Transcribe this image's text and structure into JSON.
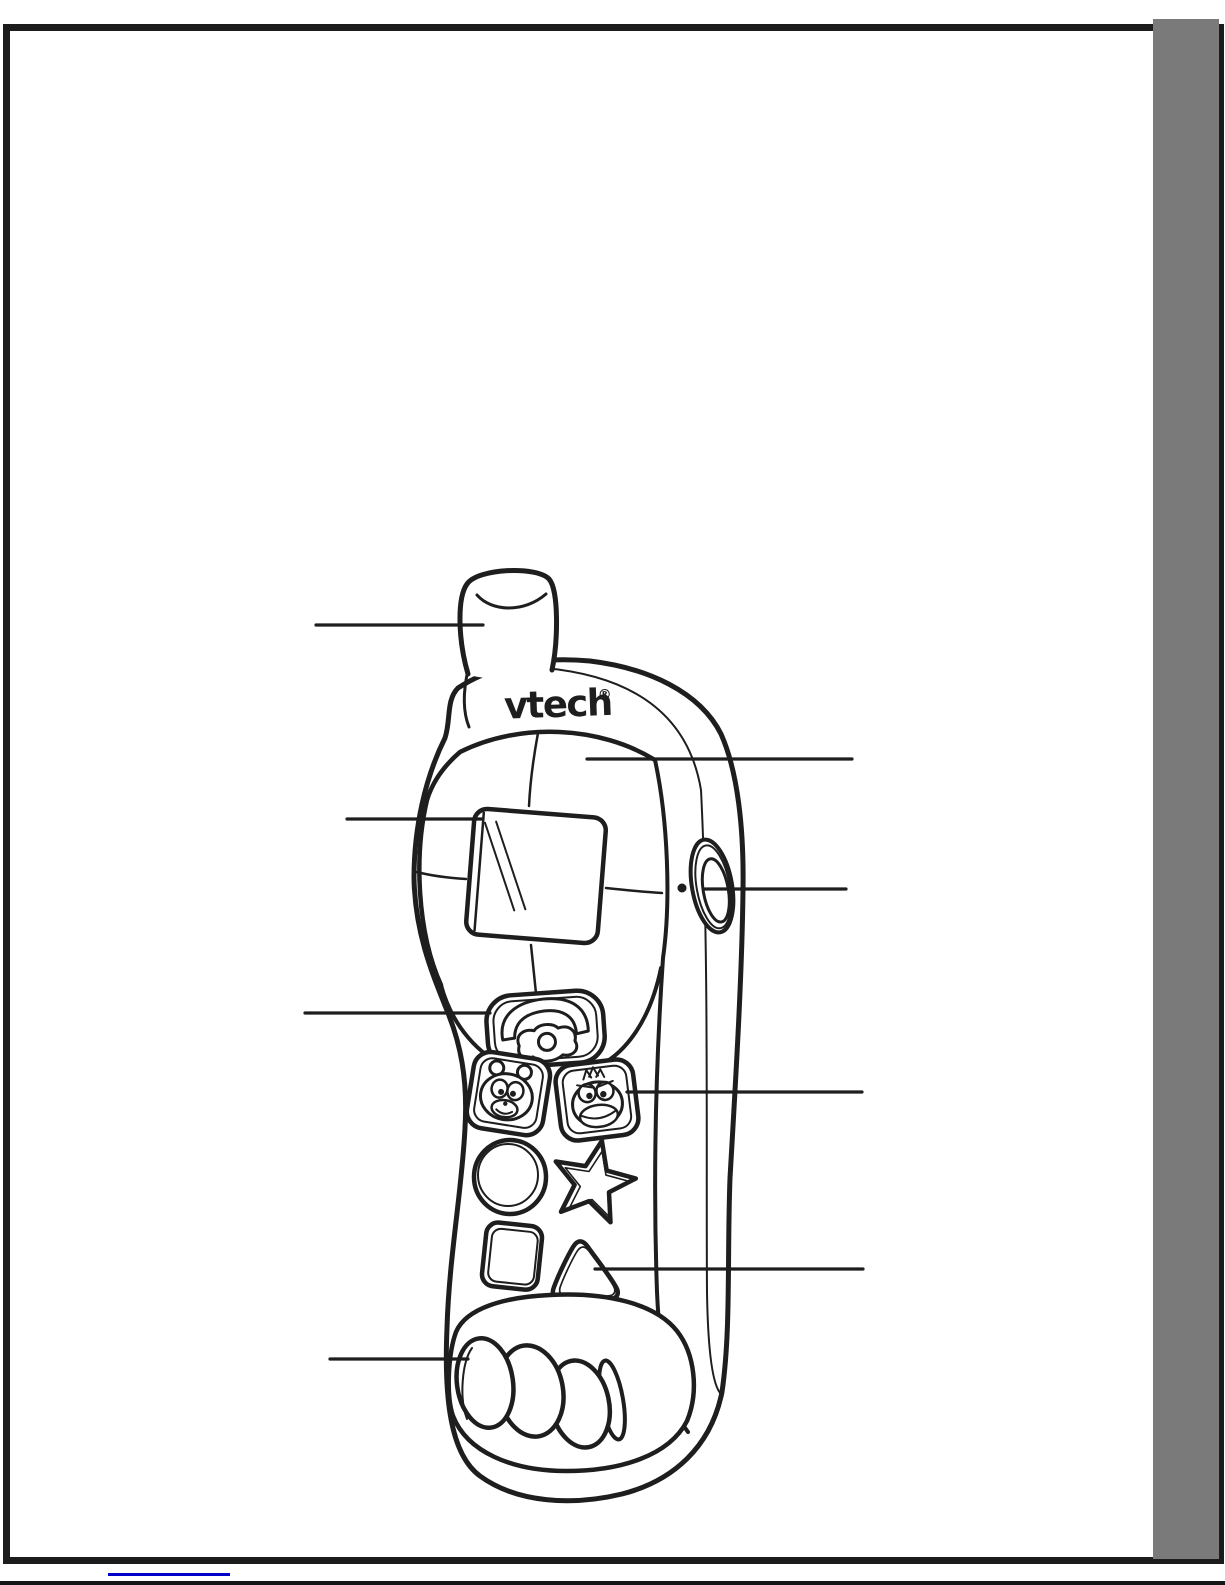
{
  "page": {
    "kind": "Scanned manual page with toy phone parts diagram",
    "logo_text": "vtech",
    "registered_mark": "®"
  },
  "figure": {
    "device": "VTech toy phone line drawing",
    "callout_count": 8
  },
  "colors": {
    "frame_black": "#1c1c1c",
    "sidebar_gray": "#7a7a7a",
    "ink": "#1e1e1e",
    "link_blue": "#0000c8",
    "paper": "#ffffff"
  }
}
